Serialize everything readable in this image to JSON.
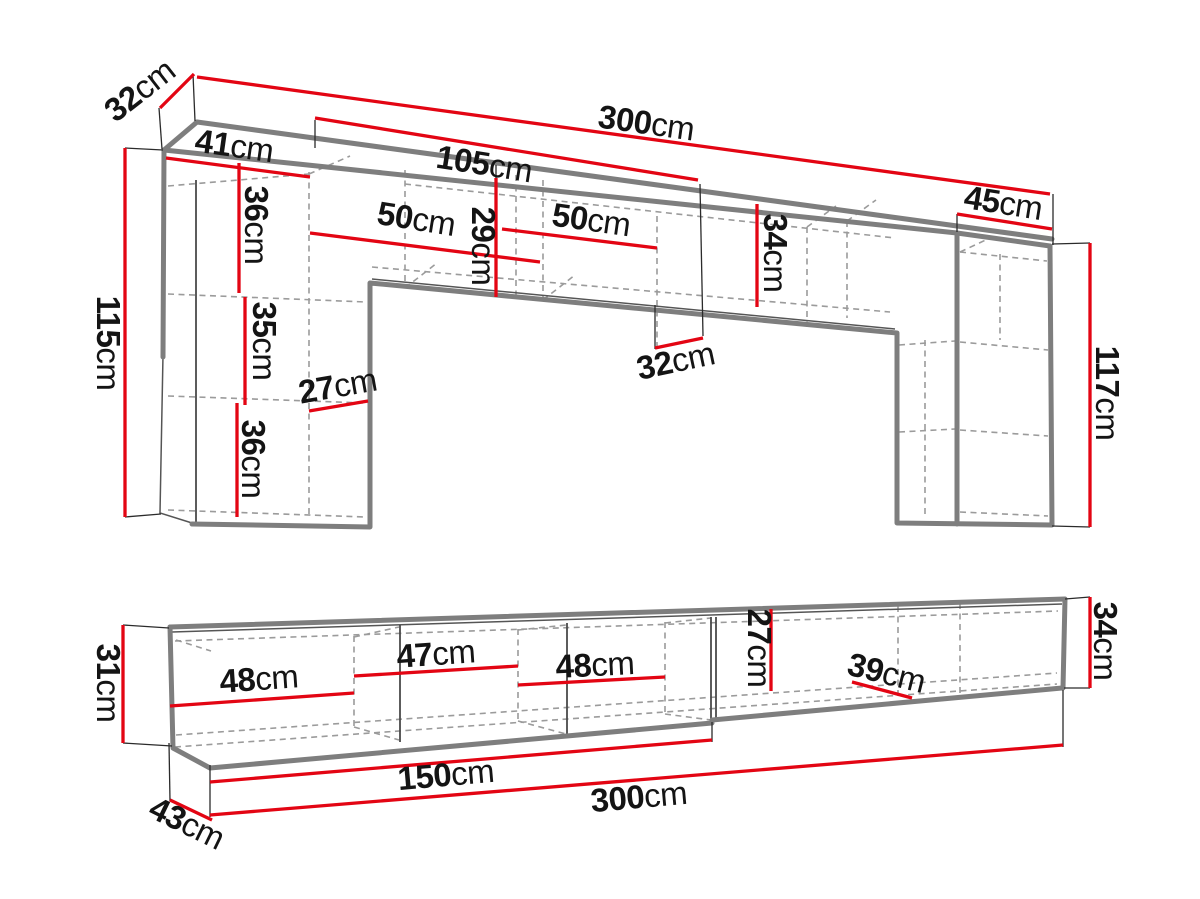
{
  "diagram_title": "Furniture wall unit and TV stand dimension diagram",
  "colors": {
    "dimension_red": "#e30513",
    "outline_gray": "#7e7e7e",
    "dashed_gray": "#9b9b9b",
    "label_text": "#141414",
    "background": "#ffffff"
  },
  "top_figure": {
    "name": "wall-unit",
    "dims": {
      "d32": {
        "v": "32",
        "u": "cm"
      },
      "d300": {
        "v": "300",
        "u": "cm"
      },
      "d105": {
        "v": "105",
        "u": "cm"
      },
      "d41": {
        "v": "41",
        "u": "cm"
      },
      "d36a": {
        "v": "36",
        "u": "cm"
      },
      "d50a": {
        "v": "50",
        "u": "cm"
      },
      "d29": {
        "v": "29",
        "u": "cm"
      },
      "d50b": {
        "v": "50",
        "u": "cm"
      },
      "d34": {
        "v": "34",
        "u": "cm"
      },
      "d45": {
        "v": "45",
        "u": "cm"
      },
      "d115": {
        "v": "115",
        "u": "cm"
      },
      "d35": {
        "v": "35",
        "u": "cm"
      },
      "d27": {
        "v": "27",
        "u": "cm"
      },
      "d36b": {
        "v": "36",
        "u": "cm"
      },
      "d32b": {
        "v": "32",
        "u": "cm"
      },
      "d117": {
        "v": "117",
        "u": "cm"
      }
    }
  },
  "bottom_figure": {
    "name": "tv-stand",
    "dims": {
      "d31": {
        "v": "31",
        "u": "cm"
      },
      "d48a": {
        "v": "48",
        "u": "cm"
      },
      "d47": {
        "v": "47",
        "u": "cm"
      },
      "d48b": {
        "v": "48",
        "u": "cm"
      },
      "d27": {
        "v": "27",
        "u": "cm"
      },
      "d39": {
        "v": "39",
        "u": "cm"
      },
      "d34": {
        "v": "34",
        "u": "cm"
      },
      "d150": {
        "v": "150",
        "u": "cm"
      },
      "d300": {
        "v": "300",
        "u": "cm"
      },
      "d43": {
        "v": "43",
        "u": "cm"
      }
    }
  }
}
